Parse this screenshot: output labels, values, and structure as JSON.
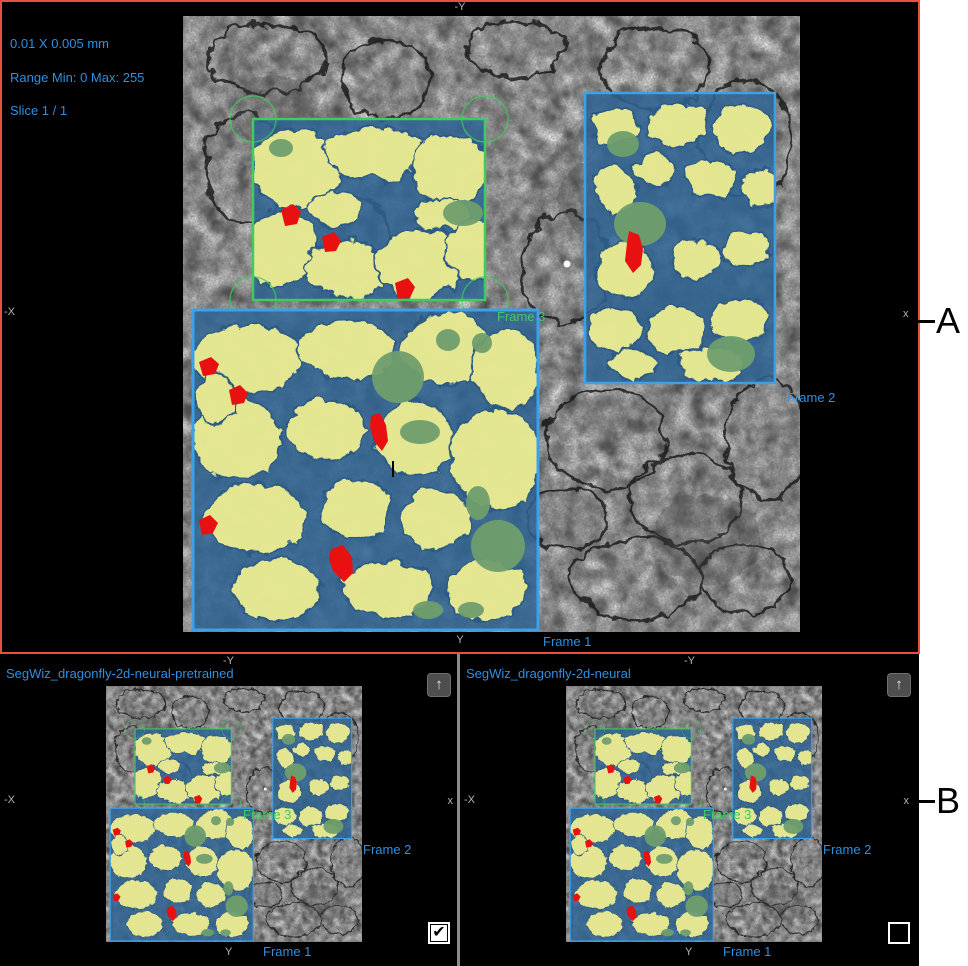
{
  "colors": {
    "accent_blue": "#2f8fe0",
    "frame_green": "#3ecc5e",
    "frame_blue": "#3da1e8",
    "border_red": "#e8523b",
    "overlay_yellow": "#eded92",
    "overlay_blue": "#2e6493",
    "overlay_green": "#6f9e6d",
    "overlay_red": "#e81010"
  },
  "top_panel": {
    "info": {
      "scale": "0.01 X 0.005 mm",
      "range": "Range Min: 0 Max: 255",
      "slice": "Slice 1 / 1"
    },
    "axis": {
      "top": "-Y",
      "left": "-X",
      "right": "x",
      "bottom": "Y"
    },
    "frame_labels": {
      "frame1": "Frame 1",
      "frame2": "Frame 2",
      "frame3": "Frame 3"
    }
  },
  "side_markers": {
    "a": "A",
    "b": "B"
  },
  "bottom_left_panel": {
    "title": "SegWiz_dragonfly-2d-neural-pretrained",
    "axis": {
      "top": "-Y",
      "left": "-X",
      "right": "x",
      "bottom": "Y"
    },
    "frame_labels": {
      "frame1": "Frame 1",
      "frame2": "Frame 2",
      "frame3": "Frame 3"
    },
    "maximize_icon": "↑",
    "checkbox": {
      "checked": true,
      "glyph": "✔"
    }
  },
  "bottom_right_panel": {
    "title": "SegWiz_dragonfly-2d-neural",
    "axis": {
      "top": "-Y",
      "left": "-X",
      "right": "x",
      "bottom": "Y"
    },
    "frame_labels": {
      "frame1": "Frame 1",
      "frame2": "Frame 2",
      "frame3": "Frame 3"
    },
    "maximize_icon": "↑",
    "checkbox": {
      "checked": false,
      "glyph": ""
    }
  }
}
